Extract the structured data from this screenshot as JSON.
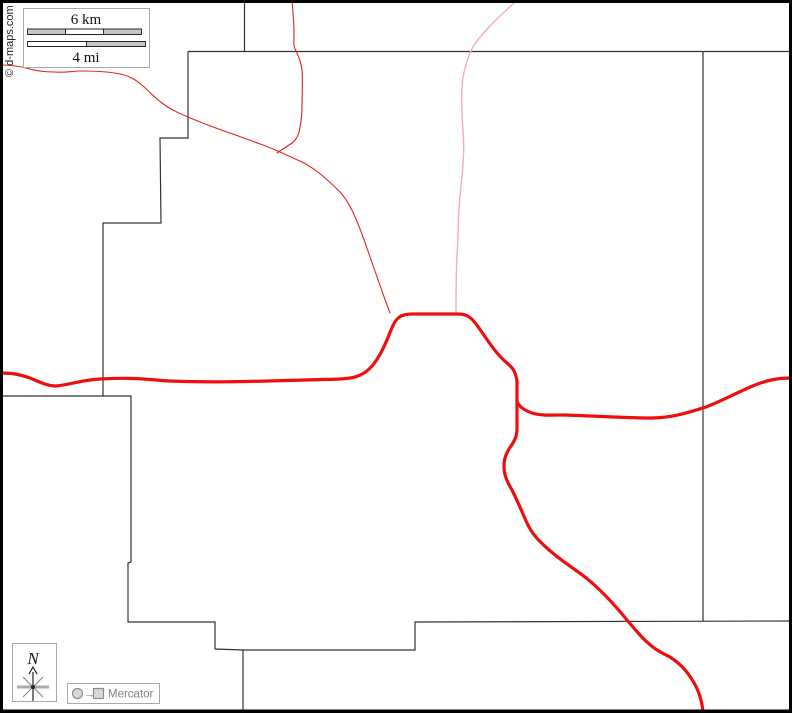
{
  "map": {
    "width": 792,
    "height": 713,
    "projection_label": "Mercator",
    "copyright": "© d-maps.com"
  },
  "scale_bar": {
    "km_label": "6 km",
    "mi_label": "4 mi"
  },
  "compass": {
    "north_label": "N"
  },
  "colors": {
    "background": "#ffffff",
    "frame": "#000000",
    "boundary": "#333333",
    "road_primary": "#ee0e0e",
    "road_secondary": "#e02222",
    "road_light": "#f2afb5",
    "box_fill": "#ffffff",
    "box_border": "#a8a8a8",
    "scale_gray": "#c6c6c6",
    "scale_white": "#ffffff",
    "scale_stroke": "#222222",
    "legend_gray": "#808080",
    "legend_icon_stroke": "#8c8c8c",
    "legend_icon_fill": "#d8d8d8",
    "compass_gray": "#aaaaaa",
    "compass_dark": "#222222",
    "text_black": "#111111"
  },
  "geometry": {
    "frame_rect": "M1.5,1.5 L790.5,1.5 L790.5,711 L1.5,711 Z",
    "frame_bottom": "M0,711.5 L792,711.5",
    "boundaries": {
      "top_stub": "M244.5,2 L244.5,51.5",
      "north_horizontal": "M188,51.5 L790,51.5",
      "west_stair": "M188,51.5 L188,138 L160,138 L161,223 L103,223 L103,396",
      "southwest_polyline": "M0,396 L131,396 L131,562 L128,563 L128,622 L215,622 L215,649 L243,650 L243,711",
      "south_horizontal": "M243,650 L415,650 L415,622 L790,621",
      "east_vertical": "M703,51.5 L703,621"
    },
    "roads": {
      "primary_main": "M0,373 C12,373 18,374 30,378 C42,383 48,386 56,386 C68,385 82,380 100,379 C140,377 150,380 170,381 C220,383 260,381 305,380 C330,379 348,380 358,376 C372,371 381,356 391,330 C396,317 401,314 412,314 L458,314 C468,314 472,318 479,328 C488,341 497,355 507,363 C513,368 516,372 517,382 L517,401",
      "primary_east_branch": "M517,401 C519,407 524,410 532,413 C542,416 552,415 565,415 C595,416 625,418 652,418 C672,418 690,412 706,407 C722,401 740,391 755,385 C768,380 778,378 792,378",
      "primary_south_branch": "M517,401 L517,429 C517,438 513,443 509,449 C505,456 504,460 504,467 C504,476 508,483 512,490 C518,502 522,512 527,523 C532,534 539,541 548,549 C560,560 572,567 585,577 C600,589 614,604 627,620 C634,628 640,636 647,642 C654,649 662,653 670,657 C678,662 686,670 691,678 C697,687 701,696 703,711",
      "secondary_diagonal": "M0,65 C10,65 18,66 26,68 C36,71 44,72 54,72 C64,73 72,71 82,71 C97,71 110,72 120,74 C130,76 136,80 143,86 C150,92 155,98 162,103 C174,112 186,116 200,122 C220,130 242,137 260,144 C275,149 288,156 302,162 C316,169 328,180 340,192 C350,203 356,218 363,237 C372,262 382,292 390,313",
      "secondary_north": "M292,0 C293,12 294,24 294,34 C294,42 293,46 296,51 C299,57 301,62 302,70 C303,82 302,95 302,105 C302,116 301,124 299,132 C297,139 294,142 289,145 C285,148 281,150 277,153",
      "light_north": "M517,0 C509,8 498,17 489,27 C481,36 474,43 470,53 C466,63 463,73 462,86 C461,101 462,116 463,131 C464,143 464,152 463,164 C462,181 460,193 459,208 C458,226 458,241 457,256 C456,276 456,296 456,313"
    },
    "scale_box": {
      "x": 23.5,
      "y": 8.5,
      "w": 126,
      "h": 59
    },
    "km_bar": {
      "seg1": "M27.5,29 h38 v5.5 h-38 Z",
      "seg2": "M65.5,29 h38 v5.5 h-38 Z",
      "seg3": "M103.5,29 h38 v5.5 h-38 Z"
    },
    "mi_bar": {
      "seg1": "M27.5,41.5 h59 v5 h-59 Z",
      "seg2": "M86.5,41.5 h59 v5 h-59 Z"
    },
    "compass_box": {
      "x": 12.5,
      "y": 643.5,
      "w": 44,
      "h": 58
    },
    "compass_star": {
      "h_bar": "M17,687 L49,687",
      "diag1": "M23,677 L43,697",
      "diag2": "M43,677 L23,697",
      "v_line": "M33,672 L33,701",
      "arrow_head": "M29,674 L33,667 L37,674"
    },
    "legend_box": {
      "x": 67.5,
      "y": 683.5,
      "w": 92,
      "h": 20
    },
    "legend_icons": {
      "circle": {
        "cx": 77.5,
        "cy": 693.5,
        "r": 5
      },
      "arrow_glyph": "→",
      "square": {
        "x": 93.5,
        "y": 688.5,
        "w": 10,
        "h": 10
      }
    }
  }
}
